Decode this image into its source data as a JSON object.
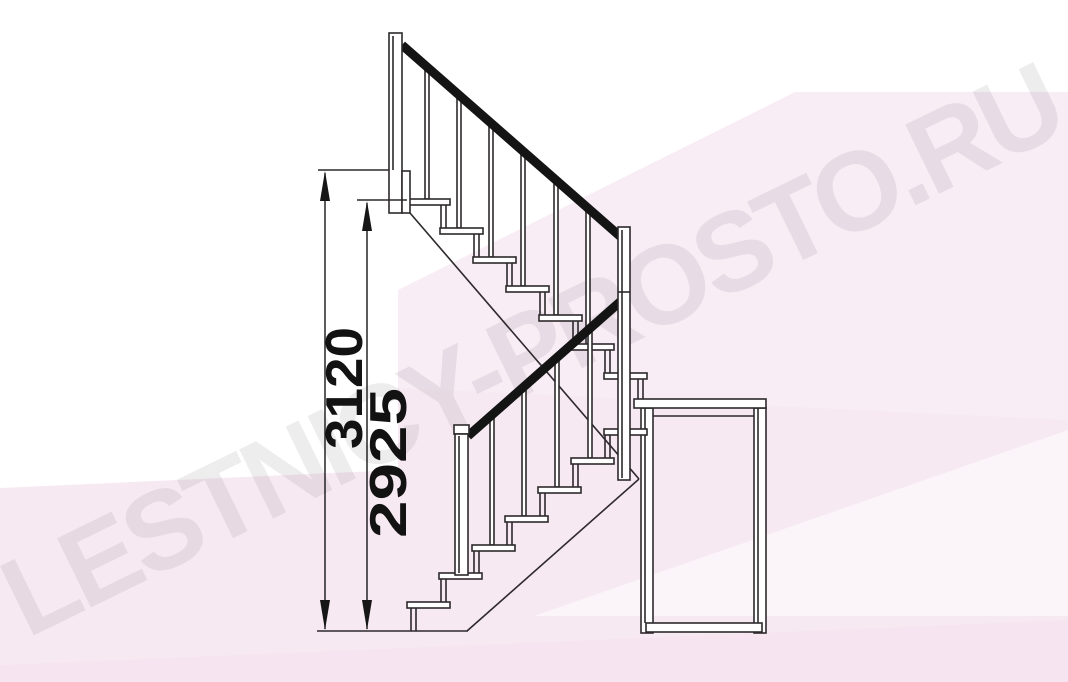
{
  "watermark": {
    "text": "LESTNICY-PROSTO.RU"
  },
  "dimensions": {
    "overall_height": "3120",
    "upper_landing_drop": "2925"
  },
  "colors": {
    "line": "#2d292c",
    "handrail": "#141414",
    "dim_text": "#121212",
    "pink_light": "#f8ecf5",
    "pink_mid": "#f7e9f2",
    "pink_deep": "#f5e3ee",
    "watermark": "rgba(118,108,118,0.12)"
  }
}
